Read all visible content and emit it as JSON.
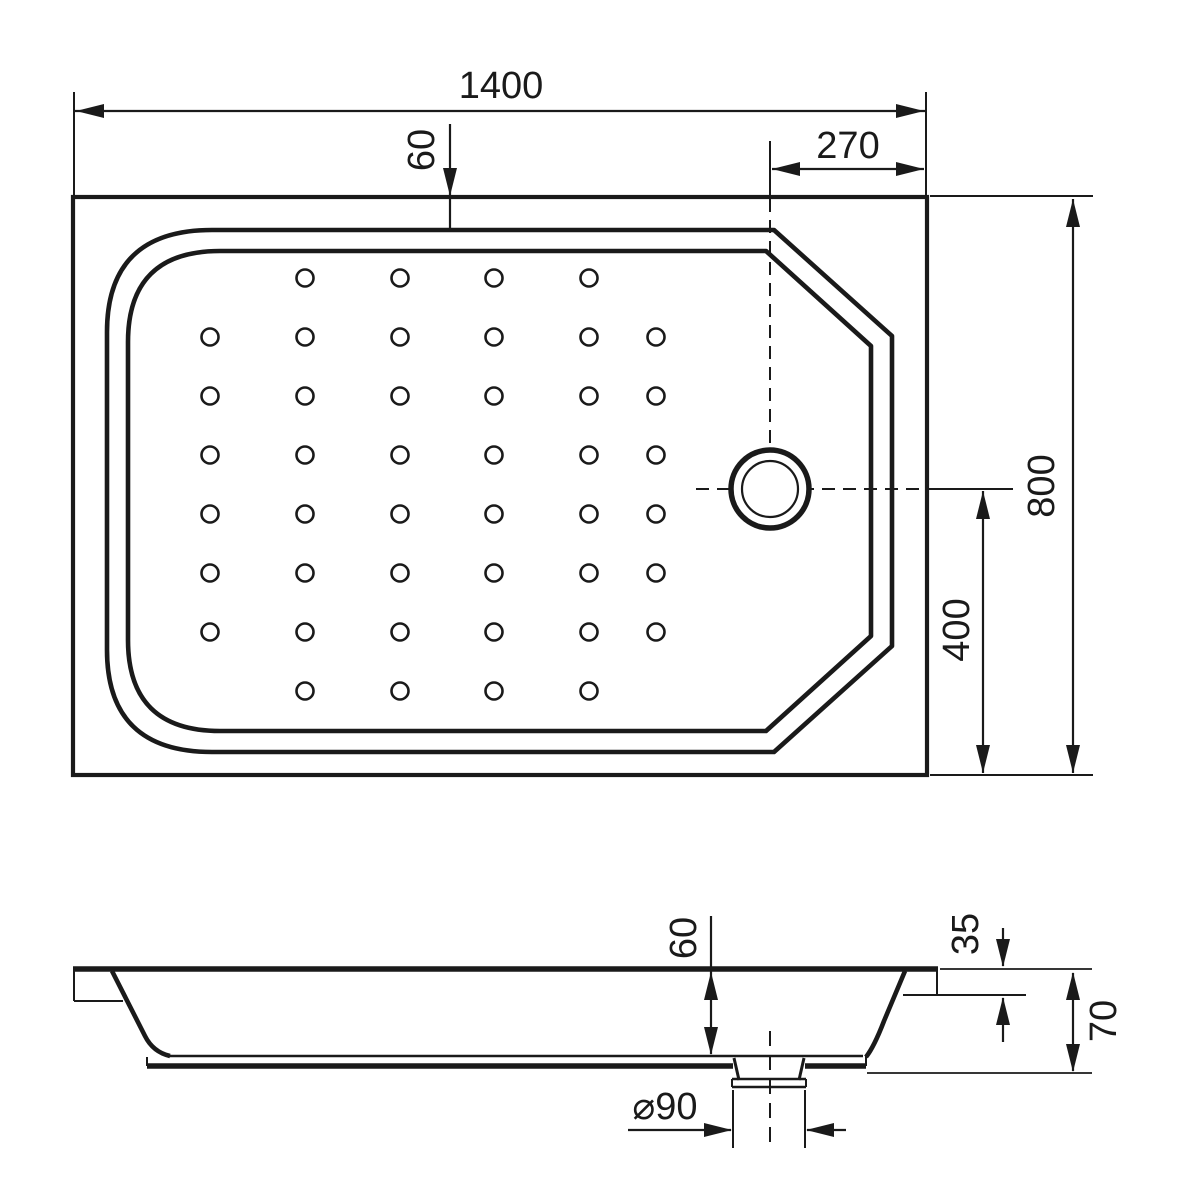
{
  "colors": {
    "line": "#1a1a1a",
    "background": "#ffffff"
  },
  "top_view": {
    "dimensions": {
      "width": "1400",
      "rim_inset_top": "60",
      "drain_from_right": "270",
      "height": "800",
      "drain_from_bottom": "400"
    },
    "dots": {
      "radius": 8.5,
      "columns_x": [
        210,
        305,
        400,
        494,
        589,
        656
      ],
      "rows": [
        {
          "y": 278,
          "col_indices": [
            1,
            2,
            3,
            4
          ]
        },
        {
          "y": 337,
          "col_indices": [
            0,
            1,
            2,
            3,
            4,
            5
          ]
        },
        {
          "y": 396,
          "col_indices": [
            0,
            1,
            2,
            3,
            4,
            5
          ]
        },
        {
          "y": 455,
          "col_indices": [
            0,
            1,
            2,
            3,
            4,
            5
          ]
        },
        {
          "y": 514,
          "col_indices": [
            0,
            1,
            2,
            3,
            4,
            5
          ]
        },
        {
          "y": 573,
          "col_indices": [
            0,
            1,
            2,
            3,
            4,
            5
          ]
        },
        {
          "y": 632,
          "col_indices": [
            0,
            1,
            2,
            3,
            4,
            5
          ]
        },
        {
          "y": 691,
          "col_indices": [
            1,
            2,
            3,
            4
          ]
        }
      ]
    }
  },
  "side_view": {
    "dimensions": {
      "basin_depth": "60",
      "ledge_height": "35",
      "total_height": "70",
      "drain_diameter": "⌀90"
    }
  }
}
